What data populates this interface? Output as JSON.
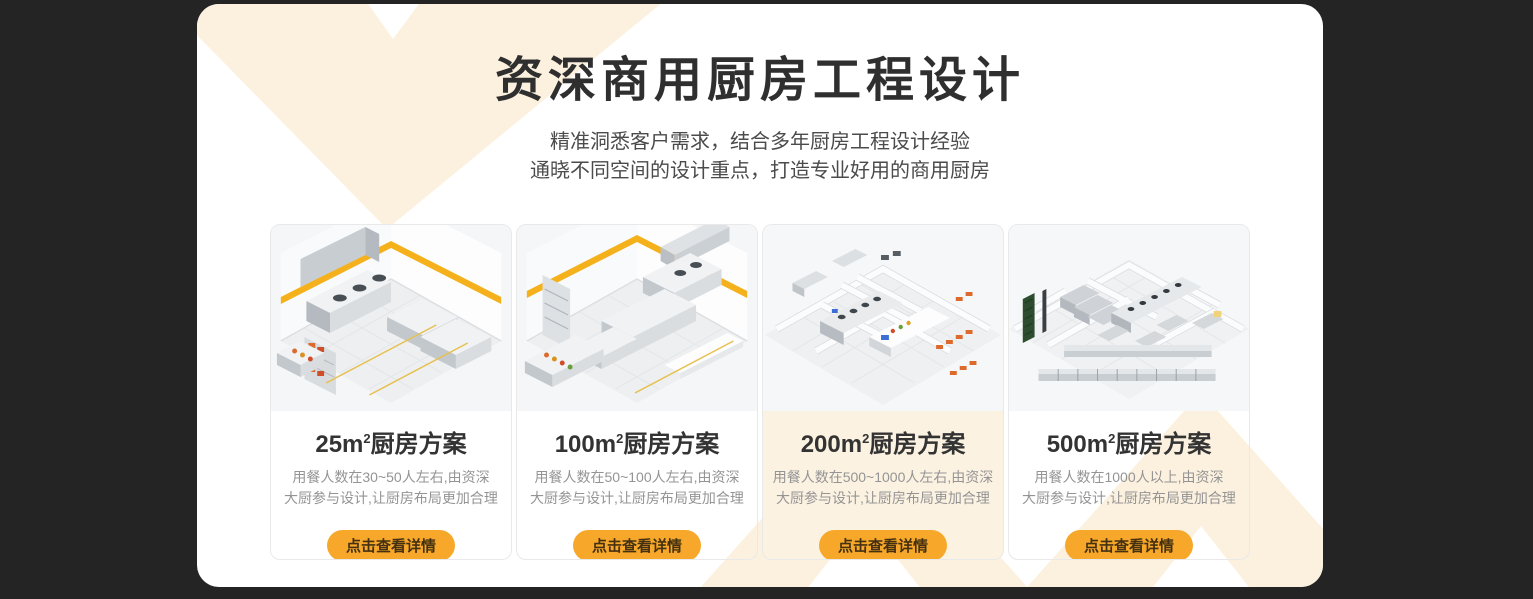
{
  "theme": {
    "page_bg": "#242424",
    "panel_bg": "#ffffff",
    "chevron_cream": "#fcf1df",
    "button_orange": "#f7a82a",
    "button_text_color": "#453111",
    "heading_color": "#2f2f2f",
    "description_color": "#949494"
  },
  "header": {
    "title": "资深商用厨房工程设计",
    "subtitle_line1": "精准洞悉客户需求，结合多年厨房工程设计经验",
    "subtitle_line2": "通晓不同空间的设计重点，打造专业好用的商用厨房"
  },
  "cards": [
    {
      "area": "25m",
      "area_sup": "2",
      "title_suffix": "厨房方案",
      "desc_line1": "用餐人数在30~50人左右,由资深",
      "desc_line2": "大厨参与设计,让厨房布局更加合理",
      "button_label": "点击查看详情",
      "image": "isometric-kitchen-render-25m2"
    },
    {
      "area": "100m",
      "area_sup": "2",
      "title_suffix": "厨房方案",
      "desc_line1": "用餐人数在50~100人左右,由资深",
      "desc_line2": "大厨参与设计,让厨房布局更加合理",
      "button_label": "点击查看详情",
      "image": "isometric-kitchen-render-100m2"
    },
    {
      "area": "200m",
      "area_sup": "2",
      "title_suffix": "厨房方案",
      "desc_line1": "用餐人数在500~1000人左右,由资深",
      "desc_line2": "大厨参与设计,让厨房布局更加合理",
      "button_label": "点击查看详情",
      "image": "isometric-kitchen-render-200m2"
    },
    {
      "area": "500m",
      "area_sup": "2",
      "title_suffix": "厨房方案",
      "desc_line1": "用餐人数在1000人以上,由资深",
      "desc_line2": "大厨参与设计,让厨房布局更加合理",
      "button_label": "点击查看详情",
      "image": "isometric-kitchen-render-500m2"
    }
  ]
}
